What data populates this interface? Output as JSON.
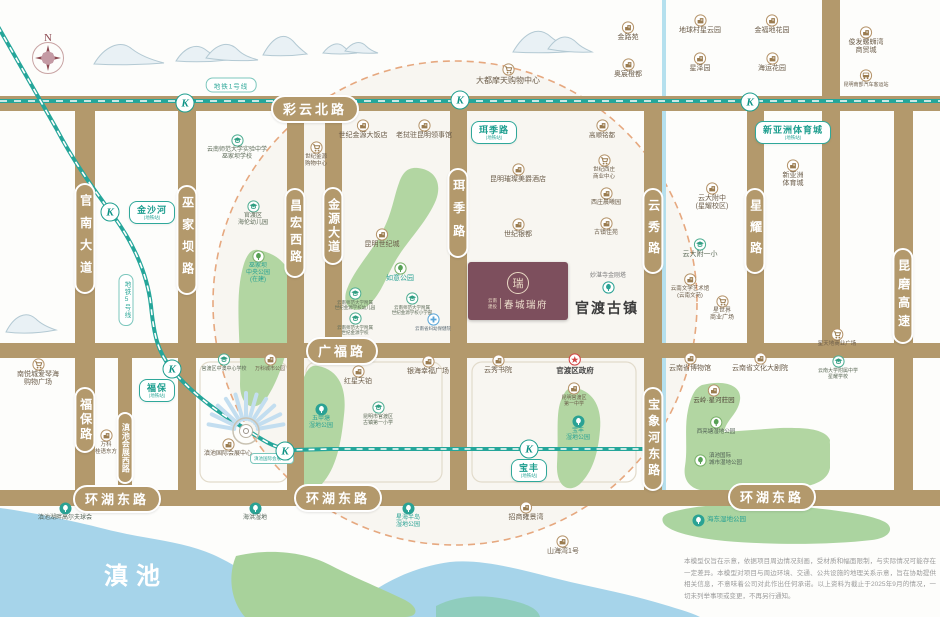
{
  "colors": {
    "road": "#b3996c",
    "metro_teal": "#1d9e8f",
    "park_green": "#b2d6a2",
    "lake_blue": "#a6d4ea",
    "radius_dash": "#e6a87f",
    "project_purple": "#7d4f5d"
  },
  "compass": {
    "north": "N"
  },
  "project": {
    "brand_line1": "云南",
    "brand_line2": "建投",
    "name": "春城瑞府",
    "seal_char": "瑞"
  },
  "big_labels": {
    "ancient_town": "官渡古镇",
    "lake": "滇池"
  },
  "metro": {
    "line1_label": "地铁1号线",
    "line5_label": "地铁5号线",
    "k_letter": "K",
    "stations": [
      {
        "name": "珥季路",
        "sub": "(地铁站)",
        "x": 494,
        "y": 121
      },
      {
        "name": "新亚洲体育城",
        "sub": "(地铁站)",
        "x": 793,
        "y": 121
      },
      {
        "name": "金沙河",
        "sub": "(地铁站)",
        "x": 152,
        "y": 201
      },
      {
        "name": "福保",
        "sub": "(地铁站)",
        "x": 157,
        "y": 379
      },
      {
        "name": "宝丰",
        "sub": "(地铁站)",
        "x": 529,
        "y": 459
      }
    ],
    "k_marks": [
      [
        185,
        103
      ],
      [
        460,
        100
      ],
      [
        750,
        102
      ],
      [
        110,
        212
      ],
      [
        172,
        369
      ],
      [
        285,
        451
      ],
      [
        529,
        449
      ]
    ]
  },
  "roads": {
    "h_pills": [
      {
        "label": "彩云北路",
        "x": 315,
        "y": 109
      },
      {
        "label": "广福路",
        "x": 342,
        "y": 351
      },
      {
        "label": "环湖东路",
        "x": 117,
        "y": 499
      },
      {
        "label": "环湖东路",
        "x": 338,
        "y": 498
      },
      {
        "label": "环湖东路",
        "x": 772,
        "y": 497
      }
    ],
    "v_pills": [
      {
        "label": "官南大道",
        "x": 85,
        "y": 183,
        "h": 107
      },
      {
        "label": "巫家坝路",
        "x": 187,
        "y": 185,
        "h": 106
      },
      {
        "label": "昌宏西路",
        "x": 295,
        "y": 188,
        "h": 86
      },
      {
        "label": "金源大道",
        "x": 333,
        "y": 187,
        "h": 74
      },
      {
        "label": "珥季路",
        "x": 458,
        "y": 168,
        "h": 86
      },
      {
        "label": "云秀路",
        "x": 653,
        "y": 188,
        "h": 82
      },
      {
        "label": "星耀路",
        "x": 755,
        "y": 188,
        "h": 82
      },
      {
        "label": "昆磨高速",
        "x": 903,
        "y": 248,
        "h": 92
      },
      {
        "label": "福保路",
        "x": 85,
        "y": 387,
        "h": 62
      },
      {
        "label": "滇池会展西路",
        "x": 125,
        "y": 412,
        "h": 68,
        "fs": 8
      },
      {
        "label": "宝象河东路",
        "x": 653,
        "y": 387,
        "h": 100
      }
    ]
  },
  "mini_badges": [
    {
      "label": "滇池国际会展中心",
      "x": 272,
      "y": 453
    }
  ],
  "markers": [
    {
      "id": "jinluyuan",
      "x": 628,
      "y": 20,
      "icon": "building",
      "label": "金路苑"
    },
    {
      "id": "aochen-chengdu",
      "x": 628,
      "y": 57,
      "icon": "building",
      "label": "奥宸橙都"
    },
    {
      "id": "diqiucun",
      "x": 700,
      "y": 13,
      "icon": "building",
      "label": "地球村星云园"
    },
    {
      "id": "jinfudi",
      "x": 772,
      "y": 13,
      "icon": "building",
      "label": "金福地花园"
    },
    {
      "id": "xingzeyuan",
      "x": 700,
      "y": 51,
      "icon": "building",
      "label": "星泽园"
    },
    {
      "id": "haiyun",
      "x": 772,
      "y": 51,
      "icon": "building",
      "label": "海运花园"
    },
    {
      "id": "junfa",
      "x": 866,
      "y": 25,
      "icon": "building",
      "label": "俊发螺蛳湾\n商贸城",
      "fs": 7
    },
    {
      "id": "bus-terminal",
      "x": 866,
      "y": 68,
      "icon": "bus",
      "label": "昆明南部汽车客运站",
      "fs": 5
    },
    {
      "id": "dadu-mall",
      "x": 508,
      "y": 62,
      "icon": "cart",
      "label": "大都摩天购物中心",
      "fs": 8
    },
    {
      "id": "shifan-wujiaba",
      "x": 237,
      "y": 133,
      "icon": "school",
      "label": "云南师范大学实验中学\n巫家坝学校",
      "fs": 6,
      "color": "#5c6a57"
    },
    {
      "id": "jinyuan-hotel",
      "x": 363,
      "y": 118,
      "icon": "building",
      "label": "世纪金源大饭店"
    },
    {
      "id": "laowo-consulate",
      "x": 424,
      "y": 118,
      "icon": "building",
      "label": "老挝驻昆明领事馆"
    },
    {
      "id": "gaoshun",
      "x": 602,
      "y": 118,
      "icon": "building",
      "label": "高顺铭都",
      "fs": 6.5
    },
    {
      "id": "jinyuan-mall",
      "x": 316,
      "y": 140,
      "icon": "cart",
      "label": "世纪金源\n购物中心",
      "fs": 5.5
    },
    {
      "id": "hailun-kindergarten",
      "x": 253,
      "y": 199,
      "icon": "school",
      "label": "官渡区\n海伦幼儿园",
      "fs": 6,
      "color": "#5c6a57"
    },
    {
      "id": "meijue-hotel",
      "x": 518,
      "y": 162,
      "icon": "building",
      "label": "昆明璀璨美爵酒店"
    },
    {
      "id": "xizhuang-center",
      "x": 604,
      "y": 153,
      "icon": "cart",
      "label": "世纪西庄\n商业中心",
      "fs": 5.5
    },
    {
      "id": "xizhuang-chenxi",
      "x": 606,
      "y": 186,
      "icon": "building",
      "label": "西庄晨曦园",
      "fs": 6
    },
    {
      "id": "guzhen-jiayuan",
      "x": 606,
      "y": 216,
      "icon": "building",
      "label": "古镇佳苑",
      "fs": 6
    },
    {
      "id": "shiji-yindu",
      "x": 518,
      "y": 217,
      "icon": "building",
      "label": "世纪银都"
    },
    {
      "id": "shijicheng",
      "x": 382,
      "y": 227,
      "icon": "building",
      "label": "昆明世纪城"
    },
    {
      "id": "ruyi-park",
      "x": 400,
      "y": 261,
      "icon": "tree-green",
      "label": "如意公园",
      "color": "#2aa294",
      "fs": 7
    },
    {
      "id": "wujiaba-park",
      "x": 258,
      "y": 249,
      "icon": "tree-green",
      "label": "巫家坝\n中央公园\n(在建)",
      "color": "#2aa294",
      "fs": 6
    },
    {
      "id": "xinyazhou-sports",
      "x": 793,
      "y": 158,
      "icon": "building",
      "label": "新亚洲\n体育城"
    },
    {
      "id": "yunda-fuzhong",
      "x": 712,
      "y": 181,
      "icon": "building",
      "label": "云大附中\n(星耀校区)"
    },
    {
      "id": "yunda-fuyixiao",
      "x": 700,
      "y": 237,
      "icon": "school",
      "label": "云大附一小",
      "color": "#5c6a57"
    },
    {
      "id": "wenxueguan",
      "x": 690,
      "y": 272,
      "icon": "building",
      "label": "云南文学艺术馆\n(云南文苑)",
      "fs": 5.5
    },
    {
      "id": "xingshijie",
      "x": 722,
      "y": 294,
      "icon": "cart",
      "label": "星世界\n商业广场",
      "fs": 6
    },
    {
      "id": "xingtiandi",
      "x": 837,
      "y": 327,
      "icon": "cart",
      "label": "星天地商业广场",
      "fs": 5.5
    },
    {
      "id": "yunda-xingyao",
      "x": 838,
      "y": 354,
      "icon": "school",
      "label": "云南大学附属中学\n星耀学校",
      "fs": 5,
      "color": "#5c6a57"
    },
    {
      "id": "pagoda",
      "x": 608,
      "y": 272,
      "icon": "tree-teal-outline",
      "label": "妙湛寺金刚塔",
      "fs": 6,
      "color": "#7a7a7a",
      "layout": "tf"
    },
    {
      "id": "nanyuecheng",
      "x": 38,
      "y": 357,
      "icon": "cart",
      "label": "南悦城爱琴海\n购物广场",
      "fs": 7
    },
    {
      "id": "wanke-guiyu",
      "x": 106,
      "y": 428,
      "icon": "building",
      "label": "万科\n桂语东方",
      "fs": 5.5
    },
    {
      "id": "zhongao-school",
      "x": 224,
      "y": 352,
      "icon": "school",
      "label": "官渡区中澳中心学校",
      "fs": 5,
      "color": "#5c6a57"
    },
    {
      "id": "wanke-park",
      "x": 270,
      "y": 352,
      "icon": "building",
      "label": "万科城市公园",
      "fs": 5
    },
    {
      "id": "expo-center",
      "x": 228,
      "y": 437,
      "icon": "building",
      "label": "滇池国际会展中心",
      "fs": 6
    },
    {
      "id": "hongxing-tianbo",
      "x": 358,
      "y": 364,
      "icon": "building",
      "label": "红星天铂"
    },
    {
      "id": "yinhai-plaza",
      "x": 428,
      "y": 354,
      "icon": "building",
      "label": "银海幸福广场"
    },
    {
      "id": "guzhen-primary",
      "x": 378,
      "y": 400,
      "icon": "school",
      "label": "昆明市官渡区\n古镇第一小学",
      "fs": 5,
      "color": "#5c6a57"
    },
    {
      "id": "wujiatang-park",
      "x": 321,
      "y": 402,
      "icon": "tree-teal-solid",
      "label": "五甲塘\n湿地公园",
      "color": "#2aa294",
      "fs": 6
    },
    {
      "id": "yunxiu-shuyuan",
      "x": 498,
      "y": 353,
      "icon": "building",
      "label": "云秀书院"
    },
    {
      "id": "guandu-gov",
      "x": 575,
      "y": 352,
      "icon": "star-red",
      "label": "官渡区政府",
      "color": "#454545",
      "fs": 7.5,
      "bold": true
    },
    {
      "id": "guandu-no1-middle",
      "x": 574,
      "y": 381,
      "icon": "building",
      "label": "昆明官渡区\n第一中学",
      "fs": 5
    },
    {
      "id": "baofeng-park",
      "x": 578,
      "y": 414,
      "icon": "tree-teal-solid",
      "label": "宝丰\n湿地公园",
      "color": "#2aa294",
      "fs": 6
    },
    {
      "id": "museum",
      "x": 690,
      "y": 351,
      "icon": "building",
      "label": "云南省博物馆"
    },
    {
      "id": "grand-theater",
      "x": 760,
      "y": 351,
      "icon": "building",
      "label": "云南省文化大剧院"
    },
    {
      "id": "yunling-xinghe",
      "x": 714,
      "y": 383,
      "icon": "building",
      "label": "云岭·星河莊园",
      "fs": 6.5,
      "color": "#554b3c"
    },
    {
      "id": "xiliangtang-park",
      "x": 716,
      "y": 415,
      "icon": "tree-green",
      "label": "西亮塘湿地公园",
      "fs": 5.5,
      "color": "#4f5f53"
    },
    {
      "id": "dianchi-city-wetland",
      "x": 718,
      "y": 452,
      "icon": "tree-green",
      "label": "滇池国际\n城市湿地公园",
      "fs": 5.5,
      "color": "#4f5f53",
      "layout": "h"
    },
    {
      "id": "golf-club",
      "x": 65,
      "y": 501,
      "icon": "tree-teal-solid",
      "label": "滇池湖畔高尔夫球会",
      "fs": 6,
      "color": "#4f5f53"
    },
    {
      "id": "haihong-wetland",
      "x": 255,
      "y": 501,
      "icon": "tree-teal-solid",
      "label": "海洪湿地",
      "fs": 6,
      "color": "#4f5f53"
    },
    {
      "id": "xinghai-peninsula",
      "x": 408,
      "y": 501,
      "icon": "tree-teal-solid",
      "label": "星海半岛\n湿地公园",
      "fs": 6,
      "color": "#2aa294"
    },
    {
      "id": "zhaoshang",
      "x": 526,
      "y": 500,
      "icon": "building",
      "label": "招商雍景湾"
    },
    {
      "id": "shanhaiwan",
      "x": 563,
      "y": 534,
      "icon": "building",
      "label": "山海湾1号"
    },
    {
      "id": "haidong-park",
      "x": 719,
      "y": 513,
      "icon": "tree-teal-solid",
      "label": "海东湿地公园",
      "layout": "h",
      "color": "#2aa294",
      "fs": 6.5
    },
    {
      "id": "fuyou-hospital",
      "x": 433,
      "y": 312,
      "icon": "cross-blue",
      "label": "云南省妇幼保健院",
      "fs": 4.5,
      "color": "#5b6b76"
    },
    {
      "id": "sjjy-kindergarten",
      "x": 355,
      "y": 286,
      "icon": "school",
      "label": "云南师范大学附属\n世纪金源学校幼儿园",
      "fs": 4.5,
      "color": "#5c6a57"
    },
    {
      "id": "sjjy-primary",
      "x": 412,
      "y": 291,
      "icon": "school",
      "label": "云南师范大学附属\n世纪金源学校小学部",
      "fs": 4.5,
      "color": "#5c6a57"
    },
    {
      "id": "sjjy-school",
      "x": 355,
      "y": 311,
      "icon": "school",
      "label": "云南师范大学附属\n世纪金源学校",
      "fs": 4.5,
      "color": "#5c6a57"
    }
  ],
  "disclaimer": "本模型仅旨在示意，依据项目周边情况刻画，受材质和幅面限制，与实际情况可能存在一定差异。本模型对项目与周边环境、交通、公共设施的地理关系示意，旨在协助提供相关信息，不意味着公司对此作出任何承诺。以上资料为截止于2025年9月的情况，一切未列举事项或变更，不再另行通知。"
}
